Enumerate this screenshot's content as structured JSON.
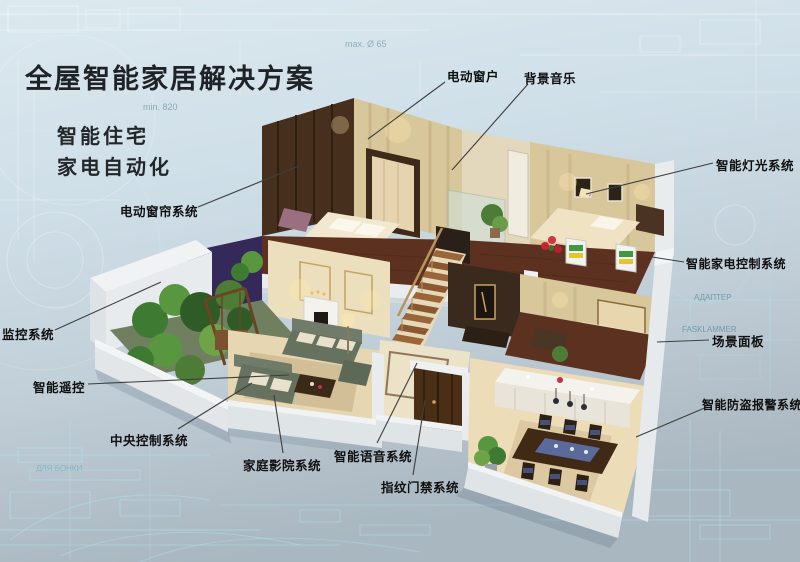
{
  "page": {
    "title": "全屋智能家居解决方案",
    "subtitles": [
      "智能住宅",
      "家电自动化"
    ]
  },
  "callouts": [
    {
      "id": "electric-window",
      "label": "电动窗户"
    },
    {
      "id": "background-music",
      "label": "背景音乐"
    },
    {
      "id": "smart-lighting",
      "label": "智能灯光系统"
    },
    {
      "id": "smart-appliance-control",
      "label": "智能家电控制系统"
    },
    {
      "id": "scene-panel",
      "label": "场景面板"
    },
    {
      "id": "burglar-alarm",
      "label": "智能防盗报警系统"
    },
    {
      "id": "electric-curtain",
      "label": "电动窗帘系统"
    },
    {
      "id": "monitoring-system",
      "label": "监控系统"
    },
    {
      "id": "smart-remote",
      "label": "智能遥控"
    },
    {
      "id": "central-control",
      "label": "中央控制系统"
    },
    {
      "id": "home-theater",
      "label": "家庭影院系统"
    },
    {
      "id": "smart-voice",
      "label": "智能语音系统"
    },
    {
      "id": "fingerprint-access",
      "label": "指纹门禁系统"
    }
  ],
  "background": {
    "watermarks": [
      "min. 820",
      "max. Ø 65",
      "АДАПТЕР",
      "FASKLAMMER",
      "A — A",
      "ДЛЯ БОНКИ"
    ]
  },
  "colors": {
    "background_top": "#dce9ef",
    "background_bottom": "#a9b7c0",
    "blueprint_line": "#aee6f2",
    "leader_line": "#3f3f3f",
    "label_text": "#101010",
    "title_text": "#1f2226"
  }
}
